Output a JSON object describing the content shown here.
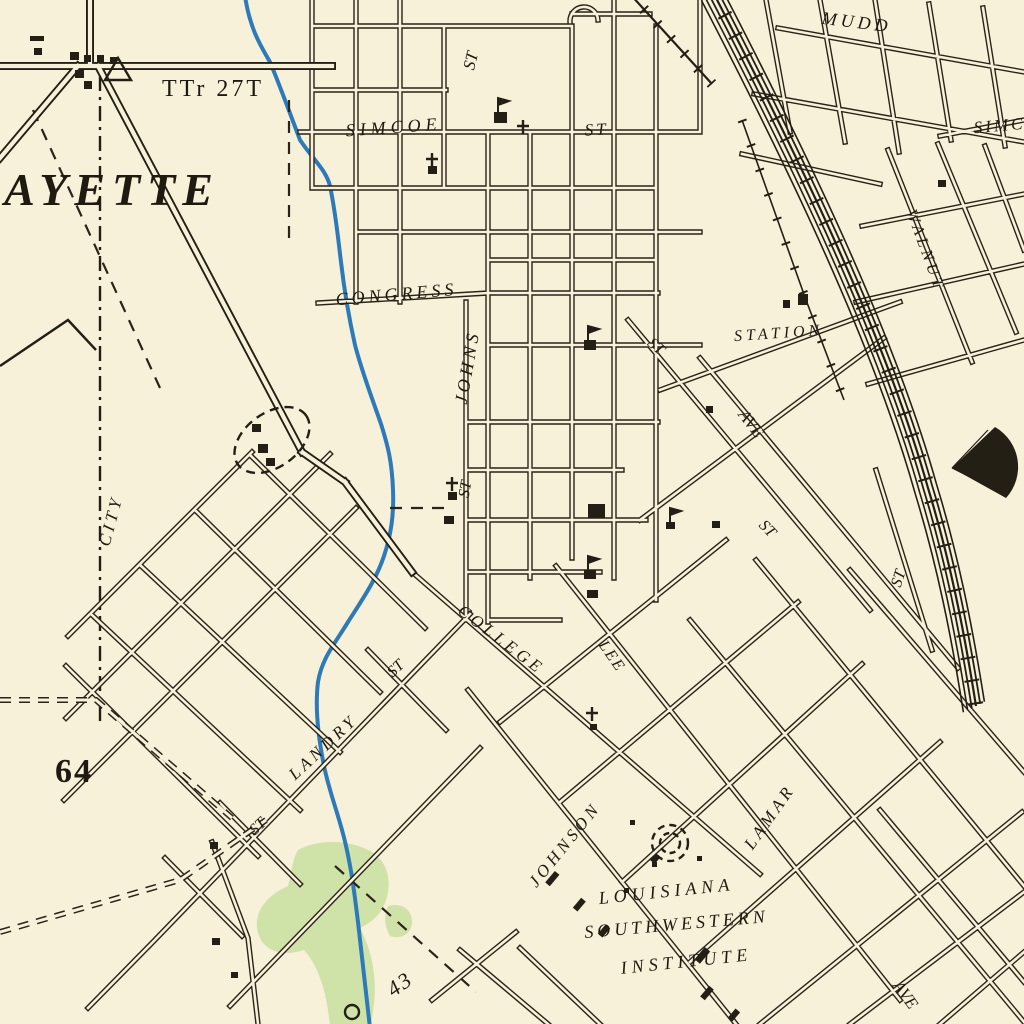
{
  "map_type": "historic-topographic-city-map",
  "colors": {
    "paper": "#f7f1da",
    "ink": "#241f14",
    "water": "#2c7ab8",
    "vegetation": "#c8df9f"
  },
  "labels": {
    "lafayette_partial": "AYETTE",
    "survey_note": "TTr 27T",
    "simcoe_west": "SIMCOE",
    "simcoe_west_st": "ST",
    "st_vertical_north": "ST",
    "mudd": "MUDD",
    "simcoe_east": "SIMC",
    "walnut": "WALNUT",
    "congress": "CONGRESS",
    "johns": "JOHNS",
    "johns_st": "ST",
    "station": "STATION",
    "st_diagonal_mid": "ST",
    "ave_northeast": "AVE",
    "st_diagonal_southeast": "ST",
    "st_east_edge": "ST",
    "city_boundary": "CITY",
    "route_64": "64",
    "college": "COLLEGE",
    "lee": "LEE",
    "st_landry_prefix": "ST",
    "st_landry_name": "LANDRY",
    "st_landry_suffix": "ST",
    "johnson": "JOHNSON",
    "lamar": "LAMAR",
    "institute_line1": "LOUISIANA",
    "institute_line2": "SOUTHWESTERN",
    "institute_line3": "INSTITUTE",
    "ave_southeast": "AVE",
    "route_43": "43"
  },
  "symbols": {
    "triangulation_station": "open-triangle",
    "church": "black-square-with-cross",
    "school": "black-square-with-flag",
    "railroad": "line-with-cross-ticks",
    "rail_yard": "parallel-track-bundle",
    "roundhouse": "black-fan-wedge",
    "water_tank": "dashed-double-circle",
    "fairground": "dashed-oval",
    "stream": "blue-meandering-line",
    "woodland": "green-tint-patch",
    "city_boundary": "dash-dot-line",
    "building": "small-black-square"
  }
}
